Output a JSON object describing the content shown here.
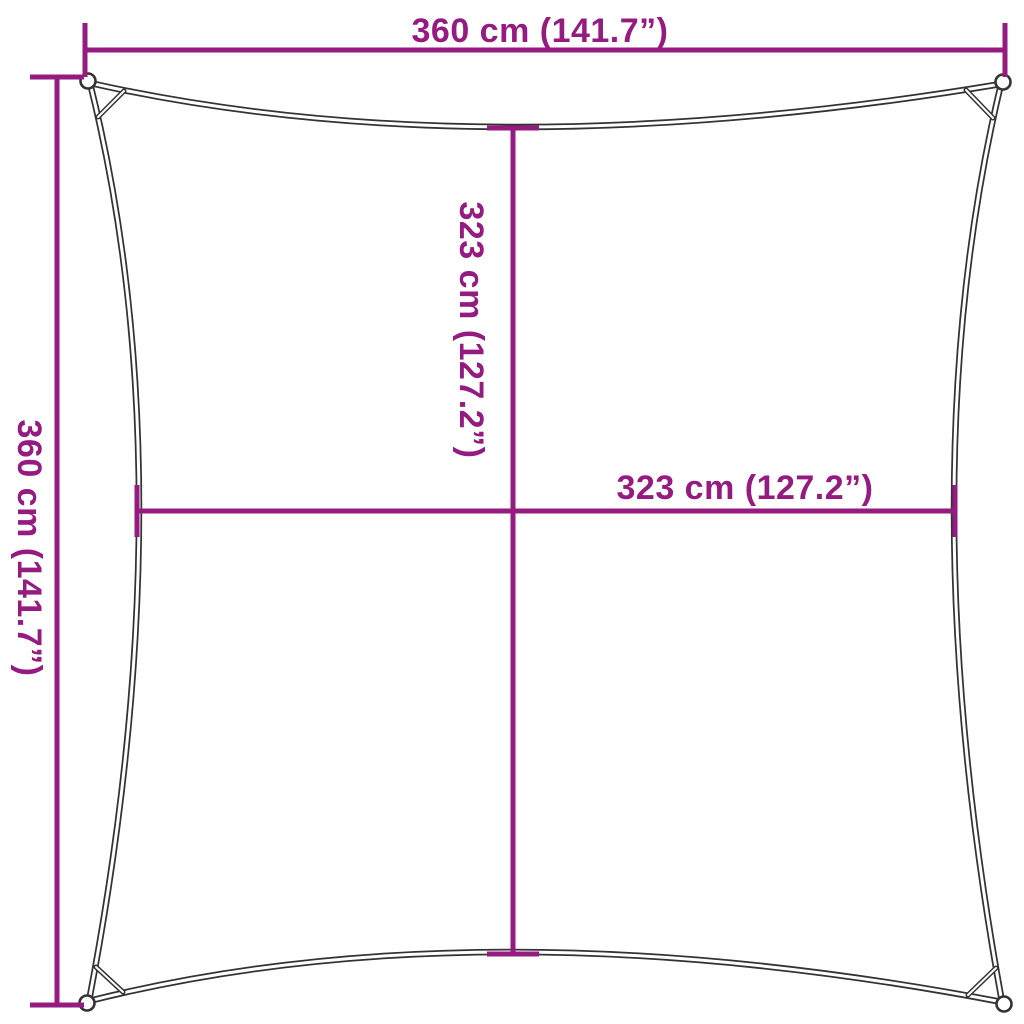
{
  "diagram": {
    "product": "square shade sail dimension diagram",
    "labels": {
      "top_width": "360 cm (141.7”)",
      "left_height": "360 cm (141.7”)",
      "inner_height": "323 cm (127.2”)",
      "inner_width": "323 cm (127.2”)"
    },
    "colors": {
      "dimension_line": "#951B81",
      "sail_outline": "#333333",
      "background": "#FFFFFF"
    }
  }
}
